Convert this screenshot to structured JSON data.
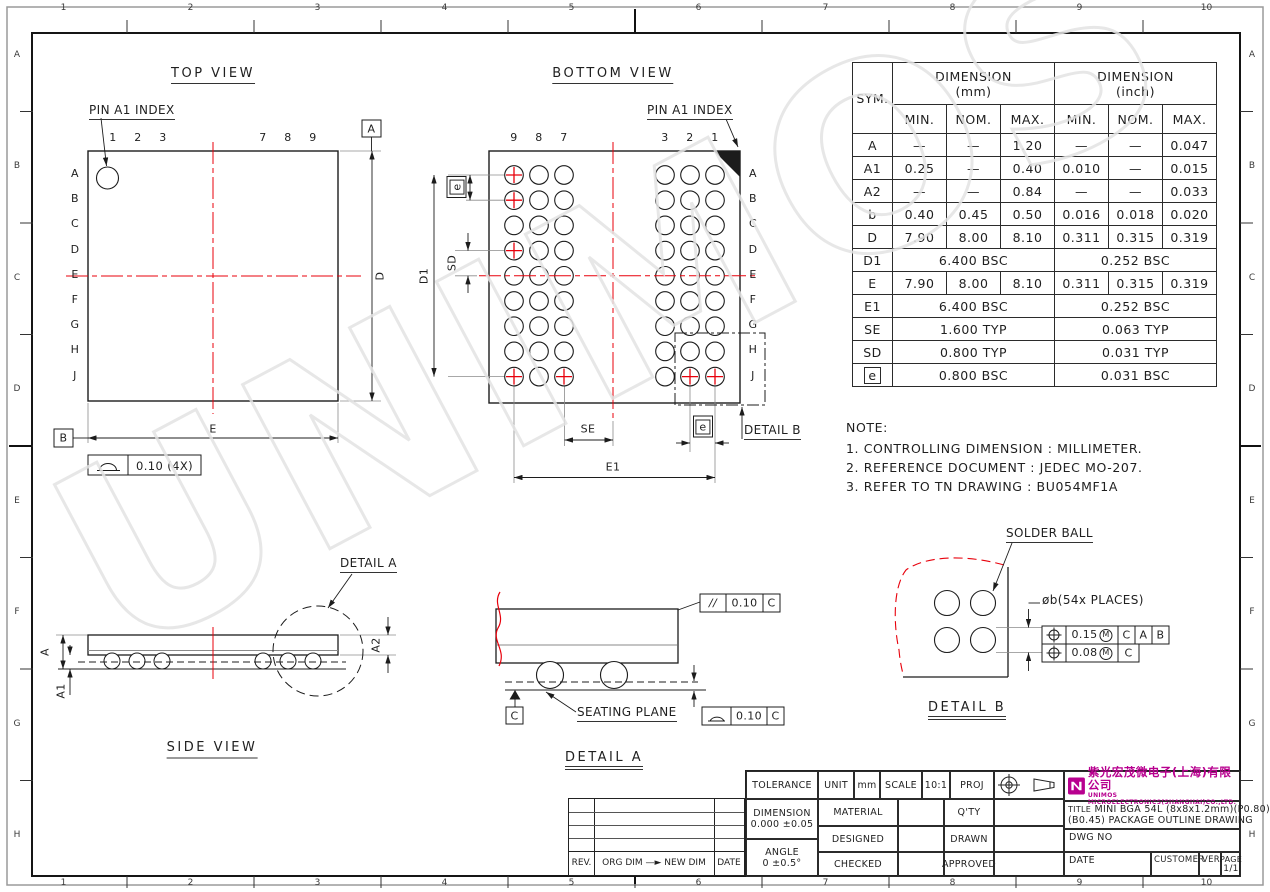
{
  "border": {
    "cols": [
      "1",
      "2",
      "3",
      "4",
      "5",
      "6",
      "7",
      "8",
      "9",
      "10"
    ],
    "rows": [
      "A",
      "B",
      "C",
      "D",
      "E",
      "F",
      "G",
      "H"
    ]
  },
  "watermark": "UNIMOS",
  "top_view": {
    "title": "TOP VIEW",
    "pin_index": "PIN A1 INDEX",
    "col_labels": [
      "1",
      "2",
      "3",
      "7",
      "8",
      "9"
    ],
    "row_labels": [
      "A",
      "B",
      "C",
      "D",
      "E",
      "F",
      "G",
      "H",
      "J"
    ],
    "datum_a": "A",
    "datum_b": "B",
    "dim_d": "D",
    "dim_e": "E",
    "flatness_value": "0.10 (4X)"
  },
  "bottom_view": {
    "title": "BOTTOM VIEW",
    "pin_index": "PIN A1 INDEX",
    "col_labels": [
      "9",
      "8",
      "7",
      "3",
      "2",
      "1"
    ],
    "row_labels": [
      "A",
      "B",
      "C",
      "D",
      "E",
      "F",
      "G",
      "H",
      "J"
    ],
    "dim_d1": "D1",
    "dim_e1": "E1",
    "dim_se": "SE",
    "dim_sd": "SD",
    "dim_e_top": "e",
    "dim_e_bottom": "e",
    "detail_b_ref": "DETAIL B"
  },
  "side_view": {
    "title": "SIDE VIEW",
    "dim_a": "A",
    "dim_a1": "A1",
    "dim_a2": "A2",
    "detail_a_ref": "DETAIL A"
  },
  "detail_a": {
    "title": "DETAIL A",
    "seating_plane": "SEATING PLANE",
    "datum_c": "C",
    "parallelism": {
      "symbol": "//",
      "value": "0.10",
      "datum": "C"
    },
    "flatness": {
      "value": "0.10",
      "datum": "C"
    }
  },
  "detail_b": {
    "title": "DETAIL B",
    "solder_ball": "SOLDER BALL",
    "ball_callout": "øb(54x PLACES)",
    "fcf1": {
      "value": "0.15",
      "modifier": "M",
      "d1": "C",
      "d2": "A",
      "d3": "B"
    },
    "fcf2": {
      "value": "0.08",
      "modifier": "M",
      "d1": "C"
    }
  },
  "table": {
    "sym_header": "SYM.",
    "mm_header_1": "DIMENSION",
    "mm_header_2": "(mm)",
    "inch_header_1": "DIMENSION",
    "inch_header_2": "(inch)",
    "sub_headers": [
      "MIN.",
      "NOM.",
      "MAX."
    ],
    "rows": [
      {
        "sym": "A",
        "mm": [
          "—",
          "—",
          "1.20"
        ],
        "inch": [
          "—",
          "—",
          "0.047"
        ]
      },
      {
        "sym": "A1",
        "mm": [
          "0.25",
          "—",
          "0.40"
        ],
        "inch": [
          "0.010",
          "—",
          "0.015"
        ]
      },
      {
        "sym": "A2",
        "mm": [
          "—",
          "—",
          "0.84"
        ],
        "inch": [
          "—",
          "—",
          "0.033"
        ]
      },
      {
        "sym": "b",
        "mm": [
          "0.40",
          "0.45",
          "0.50"
        ],
        "inch": [
          "0.016",
          "0.018",
          "0.020"
        ]
      },
      {
        "sym": "D",
        "mm": [
          "7.90",
          "8.00",
          "8.10"
        ],
        "inch": [
          "0.311",
          "0.315",
          "0.319"
        ]
      },
      {
        "sym": "D1",
        "mm_span": "6.400 BSC",
        "inch_span": "0.252 BSC"
      },
      {
        "sym": "E",
        "mm": [
          "7.90",
          "8.00",
          "8.10"
        ],
        "inch": [
          "0.311",
          "0.315",
          "0.319"
        ]
      },
      {
        "sym": "E1",
        "mm_span": "6.400 BSC",
        "inch_span": "0.252 BSC"
      },
      {
        "sym": "SE",
        "mm_span": "1.600 TYP",
        "inch_span": "0.063 TYP"
      },
      {
        "sym": "SD",
        "mm_span": "0.800 TYP",
        "inch_span": "0.031 TYP"
      },
      {
        "sym": "e",
        "boxed": true,
        "mm_span": "0.800 BSC",
        "inch_span": "0.031 BSC"
      }
    ]
  },
  "note": {
    "title": "NOTE:",
    "lines": [
      "1. CONTROLLING DIMENSION : MILLIMETER.",
      "2. REFERENCE DOCUMENT : JEDEC MO-207.",
      "3. REFER TO TN DRAWING : BU054MF1A"
    ]
  },
  "rev_table": {
    "rev": "REV.",
    "change": "ORG DIM —► NEW DIM",
    "date": "DATE"
  },
  "title_block": {
    "tolerance": "TOLERANCE",
    "dimension_label": "DIMENSION",
    "dimension_value": "0.000 ±0.05",
    "angle_label": "ANGLE",
    "angle_value": "0 ±0.5°",
    "unit_label": "UNIT",
    "unit_value": "mm",
    "scale_label": "SCALE",
    "scale_value": "10:1",
    "proj_label": "PROJ",
    "material": "MATERIAL",
    "qty": "Q'TY",
    "designed": "DESIGNED",
    "drawn": "DRAWN",
    "checked": "CHECKED",
    "approved": "APPROVED",
    "company_cn": "紫光宏茂微电子(上海)有限公司",
    "company_en": "UNIMOS MICROELECTRONICS(SHANGHAI)CO.,LTD.",
    "title_label": "TITLE",
    "title_line1": "MINI BGA 54L (8x8x1.2mm)(P0.80)",
    "title_line2": "(B0.45) PACKAGE OUTLINE DRAWING",
    "dwg_no": "DWG NO",
    "date": "DATE",
    "customer": "CUSTOMER",
    "ver": "VER.",
    "page": "PAGE",
    "page_value": "1/1"
  }
}
